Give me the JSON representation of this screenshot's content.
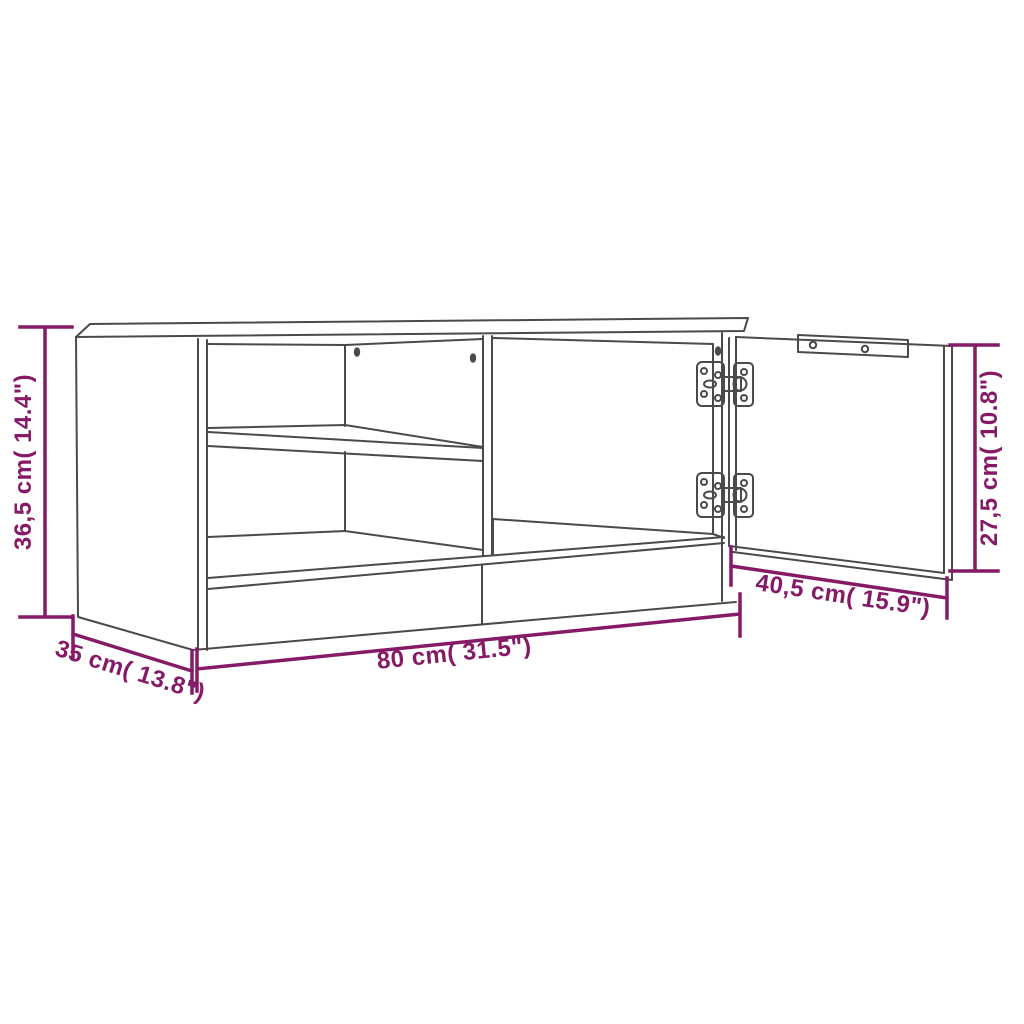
{
  "figure": {
    "type": "furniture-dimension-diagram",
    "subject": "TV cabinet line drawing with two open shelves and an open hinged door"
  },
  "diagram": {
    "colors": {
      "dimension": "#861a66",
      "outline": "#4a4a4a",
      "background": "#ffffff"
    },
    "dimensions": [
      {
        "id": "overall-height",
        "label": "36,5 cm( 14.4\")",
        "value_cm": "36,5",
        "value_in": "14.4",
        "placement": "left-vertical"
      },
      {
        "id": "door-height",
        "label": "27,5 cm( 10.8\")",
        "value_cm": "27,5",
        "value_in": "10.8",
        "placement": "right-vertical"
      },
      {
        "id": "overall-width",
        "label": "80 cm( 31.5\")",
        "value_cm": "80",
        "value_in": "31.5",
        "placement": "bottom-horizontal"
      },
      {
        "id": "depth",
        "label": "35 cm( 13.8\")",
        "value_cm": "35",
        "value_in": "13.8",
        "placement": "bottom-left-diagonal"
      },
      {
        "id": "door-width",
        "label": "40,5 cm( 15.9\")",
        "value_cm": "40,5",
        "value_in": "15.9",
        "placement": "bottom-right-diagonal"
      }
    ]
  }
}
